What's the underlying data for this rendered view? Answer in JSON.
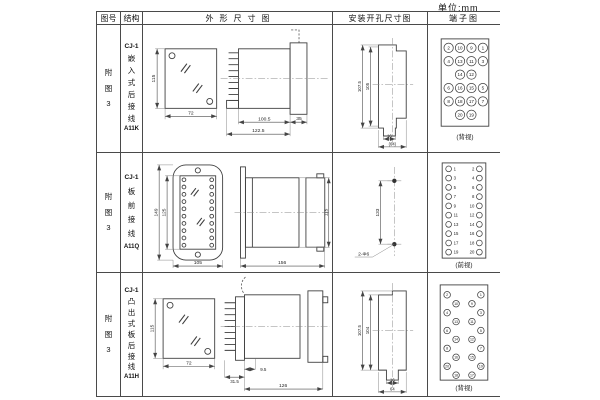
{
  "unit_label": "单位:mm",
  "headers": {
    "fig_no": "图号",
    "structure": "结构",
    "outline": "外形尺寸图",
    "mounting": "安装开孔尺寸图",
    "terminal": "端子图"
  },
  "rows": [
    {
      "fig": [
        "附",
        "图",
        "3"
      ],
      "struct": [
        "CJ-1",
        "嵌",
        "入",
        "式",
        "后",
        "接",
        "线",
        "A11K"
      ],
      "dims": {
        "front_h": "115",
        "front_w": "72",
        "side_a": "100.5",
        "side_b": "122.5",
        "side_c": "35"
      },
      "mount": {
        "v1": "107.5",
        "v2": "105",
        "h1": "16",
        "h2": "(64)"
      },
      "term": {
        "label": "(背视)",
        "n": [
          "2",
          "10",
          "9",
          "1",
          "4",
          "13",
          "11",
          "3",
          "14",
          "12",
          "6",
          "16",
          "15",
          "5",
          "8",
          "18",
          "17",
          "7",
          "20",
          "19"
        ]
      }
    },
    {
      "fig": [
        "附",
        "图",
        "3"
      ],
      "struct": [
        "CJ-1",
        "板",
        "前",
        "接",
        "线",
        "A11Q"
      ],
      "dims": {
        "front_h1": "149",
        "front_h2": "125",
        "front_w": "105",
        "side_a": "156",
        "side_b": "115"
      },
      "mount": {
        "v": "133",
        "hole": "2-Φ6"
      },
      "term": {
        "label": "(前视)",
        "left": [
          "1",
          "3",
          "5",
          "7",
          "9",
          "11",
          "13",
          "15",
          "17",
          "19"
        ],
        "right": [
          "2",
          "4",
          "6",
          "8",
          "10",
          "12",
          "14",
          "16",
          "18",
          "20"
        ]
      }
    },
    {
      "fig": [
        "附",
        "图",
        "3"
      ],
      "struct": [
        "CJ-1",
        "凸",
        "出",
        "式",
        "板",
        "后",
        "接",
        "线",
        "A11H"
      ],
      "dims": {
        "front_h": "115",
        "front_w": "72",
        "side_a": "9.5",
        "side_b": "31.5",
        "side_c": "126"
      },
      "mount": {
        "v1": "107.5",
        "v2": "104",
        "h1": "16",
        "h2": "64"
      },
      "term": {
        "label": "(背视)",
        "left": [
          "2",
          "10",
          "4",
          "13",
          "6",
          "14",
          "8",
          "16",
          "20",
          "18"
        ],
        "right": [
          "1",
          "9",
          "3",
          "11",
          "5",
          "12",
          "7",
          "15",
          "19",
          "17"
        ]
      }
    }
  ]
}
